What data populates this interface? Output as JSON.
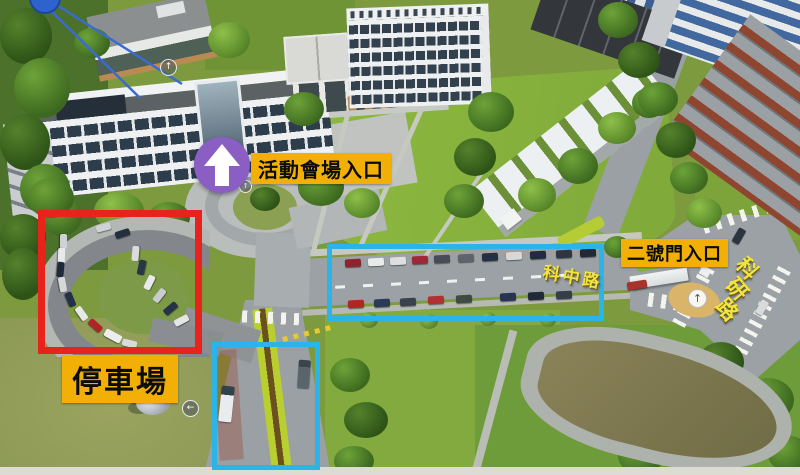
{
  "page": {
    "type": "annotated aerial drone photo used as campus wayfinding map"
  },
  "colors": {
    "highlight_red": "#e8231b",
    "highlight_cyan": "#2ab4e8",
    "label_bg": "#f2b007",
    "label_text": "#0b0b0b",
    "road_label_yellow": "#f3e43c",
    "arrow_circle_purple": "#8a5ec2"
  },
  "annotations": {
    "venue_entrance_label": "活動會場入口",
    "parking_label": "停車場",
    "gate2_label": "二號門入口",
    "road_kezhong_label": "科中路",
    "road_keyan_chars": [
      "科",
      "研",
      "路"
    ]
  },
  "icons": {
    "up_arrow": "↑",
    "left_arrow": "←"
  }
}
